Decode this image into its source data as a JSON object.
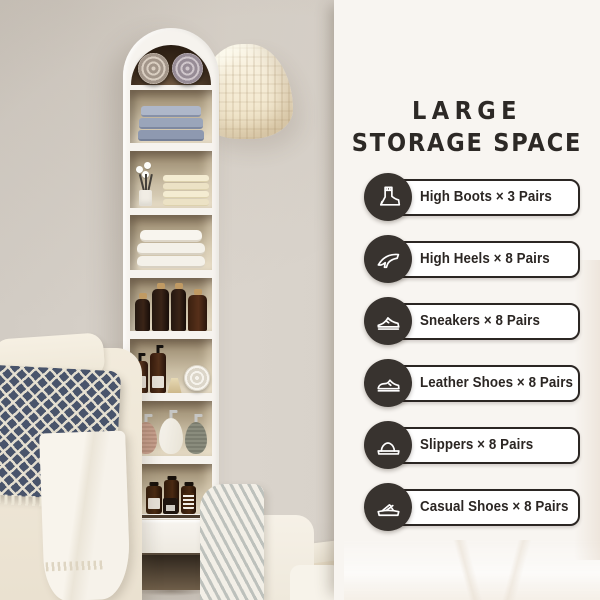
{
  "panel": {
    "title": {
      "line1": "LARGE",
      "line2": "STORAGE SPACE"
    },
    "items": [
      {
        "icon": "high-boots-icon",
        "label": "High Boots × 3 Pairs"
      },
      {
        "icon": "high-heels-icon",
        "label": "High Heels × 8 Pairs"
      },
      {
        "icon": "sneakers-icon",
        "label": "Sneakers × 8 Pairs"
      },
      {
        "icon": "leather-shoes-icon",
        "label": "Leather Shoes × 8 Pairs"
      },
      {
        "icon": "slippers-icon",
        "label": "Slippers × 8 Pairs"
      },
      {
        "icon": "casual-shoes-icon",
        "label": "Casual Shoes × 8 Pairs"
      }
    ]
  },
  "colors": {
    "panel_bg": "#f8f5f1",
    "accent_dark": "#38332f",
    "pill_border": "#2b2623",
    "title_text": "#2d2926",
    "wall": "#d6d0c8"
  }
}
